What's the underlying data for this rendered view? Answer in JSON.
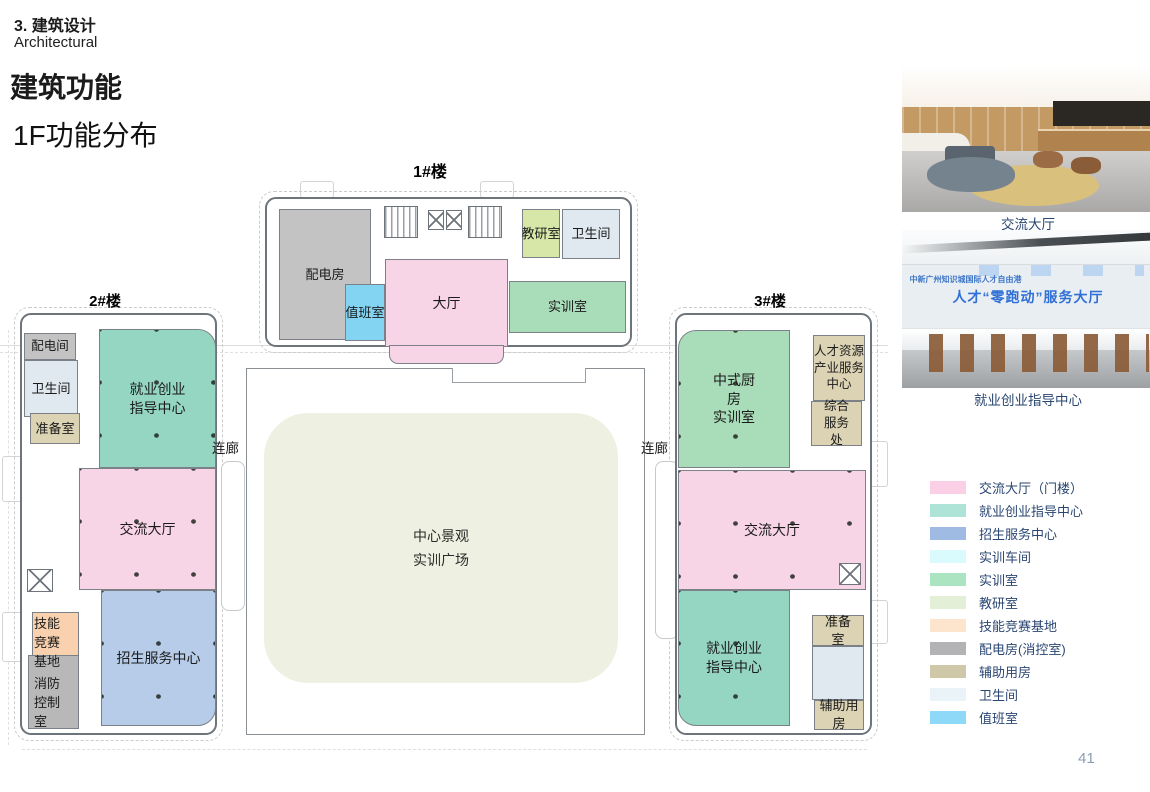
{
  "header": {
    "section_cn": "3. 建筑设计",
    "section_en": "Architectural",
    "title": "建筑功能",
    "subtitle": "1F功能分布"
  },
  "plan": {
    "building1": {
      "label": "1#楼",
      "rooms": {
        "peidianfang": "配电房",
        "zhibanshi": "值班室",
        "dating": "大厅",
        "jiaoyanshi": "教研室",
        "weishengjian": "卫生间",
        "shixunshi": "实训室"
      }
    },
    "building2": {
      "label": "2#楼",
      "rooms": {
        "peidianjian": "配电间",
        "weishengjian": "卫生间",
        "zhunbeishi": "准备室",
        "jiuye": "就业创业\n指导中心",
        "jiaoliu": "交流大厅",
        "jineng": "技能\n竞赛\n基地",
        "xiaofang": "消防\n控制\n室",
        "zhaosheng": "招生服务中心"
      }
    },
    "building3": {
      "label": "3#楼",
      "rooms": {
        "zhongshi": "中式厨\n房\n实训室",
        "rencai": "人才资源\n产业服务\n中心",
        "zonghe": "综合\n服务\n处",
        "jiaoliu": "交流大厅",
        "jiuye": "就业创业\n指导中心",
        "zhunbei": "准备\n室",
        "fuzhu": "辅助用\n房"
      }
    },
    "courtyard": "中心景观\n实训广场",
    "corridor_left": "连廊",
    "corridor_right": "连廊"
  },
  "photos": [
    {
      "caption": "交流大厅"
    },
    {
      "caption": "就业创业指导中心",
      "wall_text": "人才“零跑动”服务大厅",
      "wall_text_small": "中新广州知识城国际人才自由港"
    }
  ],
  "legend": {
    "items": [
      {
        "label": "交流大厅（门楼）",
        "color": "#fbcfe5"
      },
      {
        "label": "就业创业指导中心",
        "color": "#aee3d8"
      },
      {
        "label": "招生服务中心",
        "color": "#9fbbe3"
      },
      {
        "label": "实训车间",
        "color": "#d9fbfd"
      },
      {
        "label": "实训室",
        "color": "#abe4c0"
      },
      {
        "label": "教研室",
        "color": "#e3f0d7"
      },
      {
        "label": "技能竞赛基地",
        "color": "#fce4cd"
      },
      {
        "label": "配电房(消控室)",
        "color": "#b3b3b5"
      },
      {
        "label": "辅助用房",
        "color": "#cfc8a8"
      },
      {
        "label": "卫生间",
        "color": "#eaf3f8"
      },
      {
        "label": "值班室",
        "color": "#8ed8f8"
      }
    ]
  },
  "colors": {
    "pink": "#f7d4e6",
    "teal": "#95d6c3",
    "green": "#a9ddb9",
    "lightgreen": "#d6e7a8",
    "toilet": "#dfe9ef",
    "sky": "#83d4f2",
    "gray": "#c3c3c4",
    "gray2": "#b8b8b9",
    "tan": "#dcd3b4",
    "orange": "#f9d1ae",
    "blue": "#b6cce9",
    "courtyard": "#eef1e1"
  },
  "page_number": "41"
}
